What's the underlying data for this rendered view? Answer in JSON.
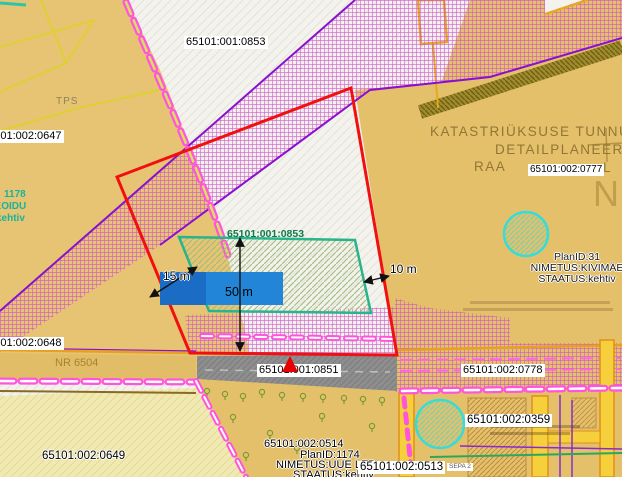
{
  "labels": {
    "parcel_top": "65101:001:0853",
    "parcel_green": "65101:001:0853",
    "parcel_0647": "65101:002:0647",
    "parcel_0648": "65101:002:0648",
    "parcel_0649": "65101:002:0649",
    "parcel_0851": "65101:001:0851",
    "parcel_0777": "65101:002:0777",
    "parcel_0778": "65101:002:0778",
    "parcel_0359": "65101:002:0359",
    "parcel_0514": "65101:002:0514",
    "parcel_0513": "65101:002:0513",
    "road_number": "NR 6504",
    "tps": "TPS",
    "sepa": "SEPA 2",
    "big_letter": "N"
  },
  "headings": {
    "line1": "KATASTRIÜKSUSE TUNNUS",
    "line2": "DETAILPLANEERING",
    "line3_prefix": "RAA",
    "line3_suffix": "L"
  },
  "plan_kivimae": {
    "id": "PlanID:31",
    "name": "NIMETUS:KIVIMÄE",
    "status": "STAATUS:kehtiv"
  },
  "plan_uue_lepiku": {
    "id": "PlanID:1174",
    "name": "NIMETUS:UUE LEP",
    "status": "STAATUS:kehtiv"
  },
  "plan_left_fragment": {
    "id": "1178",
    "name": "KOIDU",
    "status": "kehtiv"
  },
  "dimensions": {
    "left": "15 m",
    "width": "50 m",
    "right": "10 m"
  },
  "colors": {
    "plan_boundary": "#f01010",
    "target_parcel_outline": "#28b48c",
    "building_area": "#2285d8",
    "restriction_crosshatch": "#cf4ccf",
    "highlight_circle": "#35dcd8",
    "road_fill": "#8e8e8e",
    "parcel_fill": "#e5c06b"
  }
}
